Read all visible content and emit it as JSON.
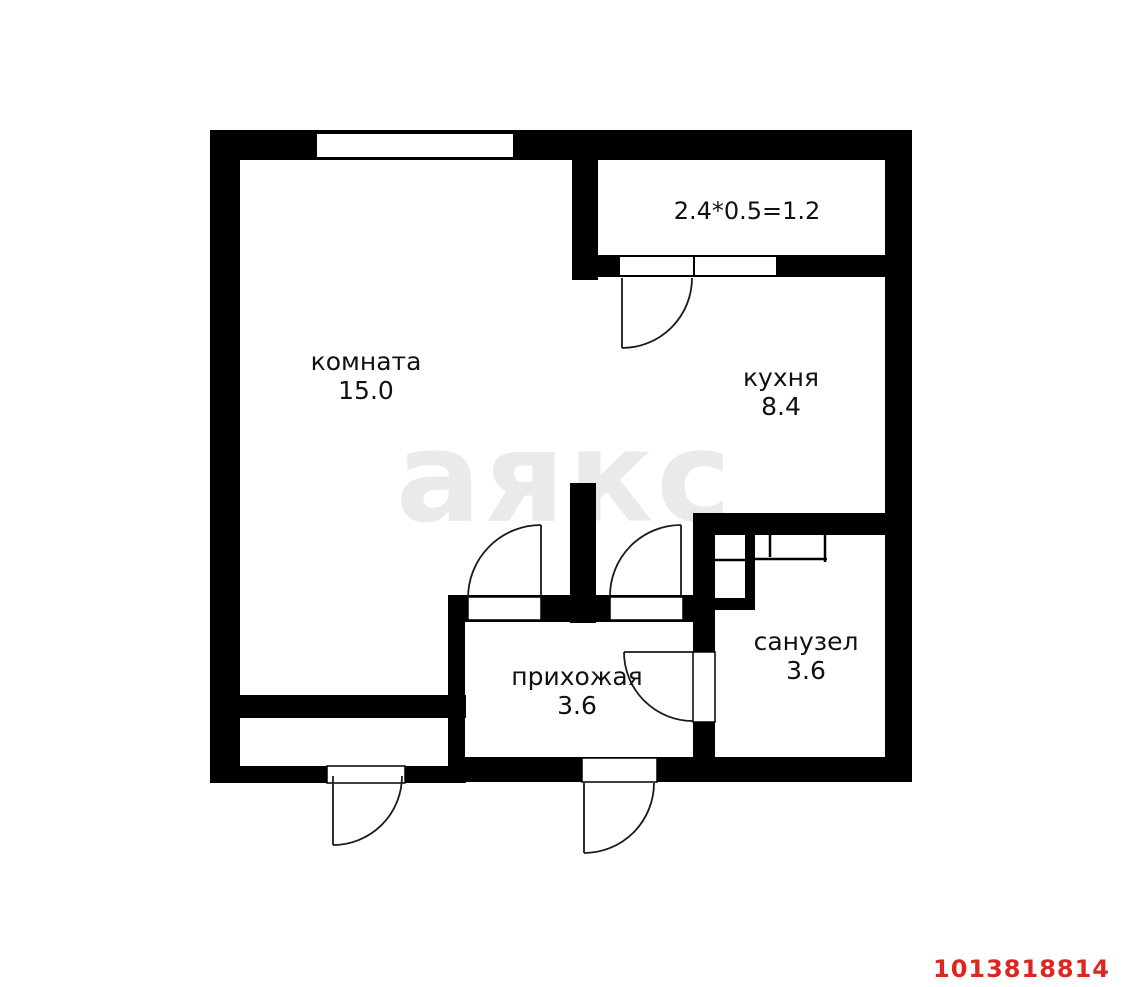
{
  "plan": {
    "rooms": [
      {
        "id": "room",
        "name": "комната",
        "area": "15.0"
      },
      {
        "id": "kitchen",
        "name": "кухня",
        "area": "8.4"
      },
      {
        "id": "hallway",
        "name": "прихожая",
        "area": "3.6"
      },
      {
        "id": "bathroom",
        "name": "санузел",
        "area": "3.6"
      }
    ],
    "balcony_label": "2.4*0.5=1.2",
    "watermark": "аякс",
    "listing_id": "1013818814",
    "colors": {
      "wall": "#000000",
      "background": "#ffffff",
      "watermark": "#eaeaea",
      "listing_id": "#dc2620"
    }
  }
}
